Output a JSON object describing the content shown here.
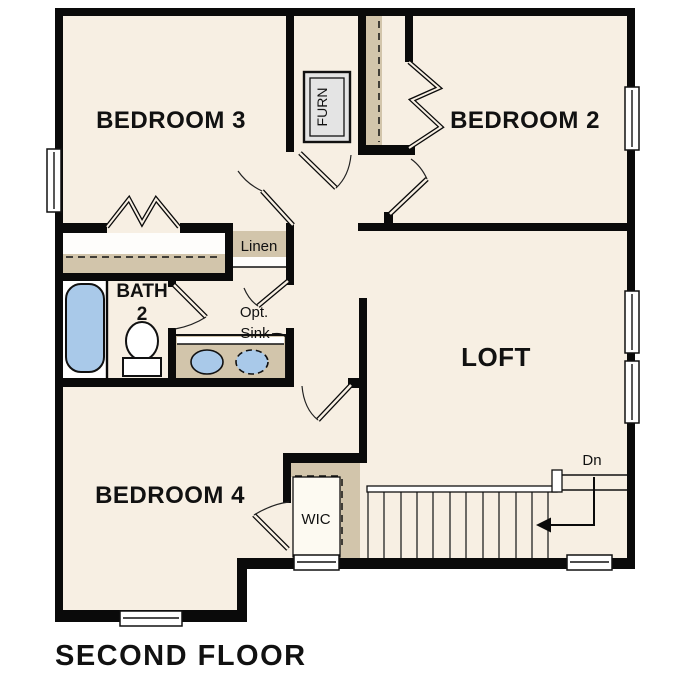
{
  "plan": {
    "title": "SECOND FLOOR",
    "rooms": {
      "bedroom3": "BEDROOM 3",
      "bedroom2": "BEDROOM 2",
      "bedroom4": "BEDROOM 4",
      "loft": "LOFT",
      "bath_line1": "BATH",
      "bath_line2": "2",
      "wic": "WIC",
      "linen": "Linen",
      "furnace": "FURN",
      "opt_sink_line1": "Opt.",
      "opt_sink_line2": "Sink",
      "stairs_direction": "Dn"
    },
    "colors": {
      "wall": "#0a0a0a",
      "floor": "#f7efe3",
      "casework_tan": "#d2c5ab",
      "fixture_blue": "#a9c9e9",
      "equipment_gray": "#e4e4e4",
      "background": "#ffffff"
    }
  }
}
